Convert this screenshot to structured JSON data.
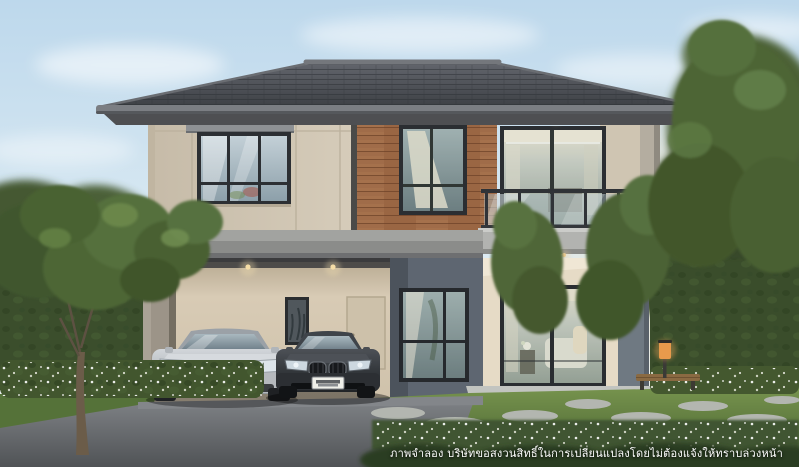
{
  "scene": {
    "kind": "real-estate-exterior-render",
    "disclaimer_text": "ภาพจำลอง บริษัทขอสงวนสิทธิ์ในการเปลี่ยนแปลงโดยไม่ต้องแจ้งให้ทราบล่วงหน้า"
  },
  "palette": {
    "sky_top": "#c3dcee",
    "sky_horizon": "#eef4f6",
    "sky_warm": "#f4e7cd",
    "roof_tile": "#4a4d52",
    "wall_beige": "#d0c6b4",
    "wall_beige_sunlit": "#e6dbc6",
    "wall_gray_blue": "#5e6671",
    "wood_panel": "#a06c49",
    "window_frame": "#2b2e32",
    "slab_gray": "#8b8c8a",
    "hedge_green": "#3b4e2c",
    "lawn_green": "#5f7c40",
    "driveway_gray": "#6b6e72",
    "car_silver": "#c4c8cc",
    "car_dark_gray": "#35383c",
    "downlight_warm": "#f5d9a8",
    "garden_lamp_glow": "#f0a85a"
  }
}
